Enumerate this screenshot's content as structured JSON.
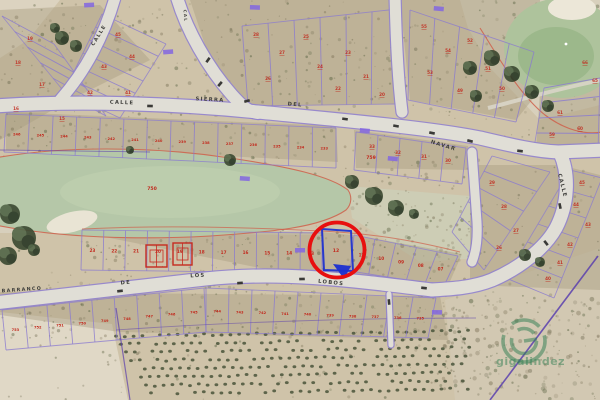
{
  "map": {
    "type": "aerial-cadastral-map",
    "street_labels": [
      {
        "text": "CALLE",
        "x": 100,
        "y": 36,
        "rot": -58,
        "size": 5.0
      },
      {
        "text": "CAL",
        "x": 184,
        "y": 16,
        "rot": 85,
        "size": 4.0
      },
      {
        "text": "CALLE",
        "x": 122,
        "y": 104,
        "rot": 2,
        "size": 5.2
      },
      {
        "text": "SIERRA",
        "x": 210,
        "y": 101,
        "rot": 3,
        "size": 5.2
      },
      {
        "text": "DEL",
        "x": 295,
        "y": 106,
        "rot": 5,
        "size": 5.2
      },
      {
        "text": "NAVAR",
        "x": 443,
        "y": 147,
        "rot": 17,
        "size": 5.2
      },
      {
        "text": "CALLE",
        "x": 561,
        "y": 186,
        "rot": 76,
        "size": 5.2
      },
      {
        "text": "BARRANCO",
        "x": 22,
        "y": 291,
        "rot": -4,
        "size": 4.8
      },
      {
        "text": "DE",
        "x": 126,
        "y": 284,
        "rot": -6,
        "size": 5.2
      },
      {
        "text": "LOS",
        "x": 198,
        "y": 277,
        "rot": -3,
        "size": 5.2
      },
      {
        "text": "LOBOS",
        "x": 331,
        "y": 284,
        "rot": 6,
        "size": 5.2
      }
    ],
    "red_labels": [
      {
        "text": "750",
        "x": 152,
        "y": 190
      },
      {
        "text": "759",
        "x": 371,
        "y": 159
      }
    ],
    "highlight": {
      "circled_parcel_number": "12",
      "circle_color": "#e80f0f",
      "parcel_outline_color": "#1b2fd0"
    },
    "parcel_strips": {
      "E": {
        "numbers": [
          "246",
          "245",
          "244",
          "243",
          "242",
          "241",
          "240",
          "239",
          "238",
          "237",
          "236",
          "235",
          "234",
          "233"
        ],
        "size": 3.6
      },
      "H": {
        "numbers": [
          "23",
          "22",
          "21",
          "20",
          "19",
          "18",
          "17",
          "16",
          "15",
          "14",
          "13"
        ],
        "size": 4.2
      },
      "H2": {
        "numbers": [
          "11",
          "10",
          "09",
          "08",
          "07"
        ],
        "size": 4.2
      },
      "I1": {
        "numbers": [
          "753",
          "752",
          "751",
          "750",
          "749",
          "748",
          "747",
          "746",
          "745"
        ],
        "size": 3.6
      },
      "I2": {
        "numbers": [
          "744",
          "743",
          "742",
          "741",
          "740",
          "739",
          "738",
          "737",
          "736",
          "735"
        ],
        "size": 3.6
      }
    },
    "loose_parcel_numbers": [
      {
        "t": "19",
        "x": 30,
        "y": 40
      },
      {
        "t": "18",
        "x": 18,
        "y": 64
      },
      {
        "t": "17",
        "x": 42,
        "y": 86
      },
      {
        "t": "16",
        "x": 16,
        "y": 110
      },
      {
        "t": "15",
        "x": 62,
        "y": 120
      },
      {
        "t": "45",
        "x": 118,
        "y": 36
      },
      {
        "t": "44",
        "x": 132,
        "y": 58
      },
      {
        "t": "43",
        "x": 104,
        "y": 68
      },
      {
        "t": "42",
        "x": 90,
        "y": 94
      },
      {
        "t": "41",
        "x": 128,
        "y": 94
      },
      {
        "t": "28",
        "x": 256,
        "y": 36
      },
      {
        "t": "27",
        "x": 282,
        "y": 54
      },
      {
        "t": "26",
        "x": 268,
        "y": 80
      },
      {
        "t": "25",
        "x": 306,
        "y": 38
      },
      {
        "t": "24",
        "x": 320,
        "y": 68
      },
      {
        "t": "23",
        "x": 348,
        "y": 54
      },
      {
        "t": "22",
        "x": 338,
        "y": 90
      },
      {
        "t": "21",
        "x": 366,
        "y": 78
      },
      {
        "t": "20",
        "x": 382,
        "y": 96
      },
      {
        "t": "55",
        "x": 424,
        "y": 28
      },
      {
        "t": "54",
        "x": 448,
        "y": 52
      },
      {
        "t": "53",
        "x": 430,
        "y": 74
      },
      {
        "t": "52",
        "x": 470,
        "y": 42
      },
      {
        "t": "51",
        "x": 488,
        "y": 70
      },
      {
        "t": "50",
        "x": 502,
        "y": 90
      },
      {
        "t": "49",
        "x": 460,
        "y": 92
      },
      {
        "t": "61",
        "x": 560,
        "y": 114
      },
      {
        "t": "60",
        "x": 580,
        "y": 130
      },
      {
        "t": "59",
        "x": 552,
        "y": 136
      },
      {
        "t": "66",
        "x": 585,
        "y": 64
      },
      {
        "t": "65",
        "x": 595,
        "y": 82
      },
      {
        "t": "33",
        "x": 372,
        "y": 148
      },
      {
        "t": "32",
        "x": 398,
        "y": 154
      },
      {
        "t": "31",
        "x": 424,
        "y": 158
      },
      {
        "t": "30",
        "x": 448,
        "y": 162
      },
      {
        "t": "29",
        "x": 492,
        "y": 184
      },
      {
        "t": "28",
        "x": 504,
        "y": 208
      },
      {
        "t": "27",
        "x": 516,
        "y": 232
      },
      {
        "t": "26",
        "x": 499,
        "y": 249
      },
      {
        "t": "45",
        "x": 582,
        "y": 184
      },
      {
        "t": "44",
        "x": 576,
        "y": 206
      },
      {
        "t": "43",
        "x": 588,
        "y": 226
      },
      {
        "t": "42",
        "x": 570,
        "y": 246
      },
      {
        "t": "41",
        "x": 560,
        "y": 264
      },
      {
        "t": "40",
        "x": 548,
        "y": 280
      }
    ],
    "violet_markers": [
      [
        84,
        3
      ],
      [
        250,
        5
      ],
      [
        434,
        6
      ],
      [
        163,
        50
      ],
      [
        360,
        128
      ],
      [
        388,
        156
      ],
      [
        295,
        248
      ],
      [
        432,
        310
      ],
      [
        240,
        176
      ]
    ],
    "watermark": {
      "text": "gigalindez",
      "color": "#2f7d52"
    },
    "colors": {
      "road": "#e0ded6",
      "road_edge": "#9183cf",
      "parcel_line": "#8a7ad0",
      "parcel_number": "#c22a1e",
      "golf_green": "#aec39c",
      "fairway": "#b5c7a8",
      "red_boundary": "#cf5f4a",
      "ground": "#cfc3a9"
    }
  }
}
